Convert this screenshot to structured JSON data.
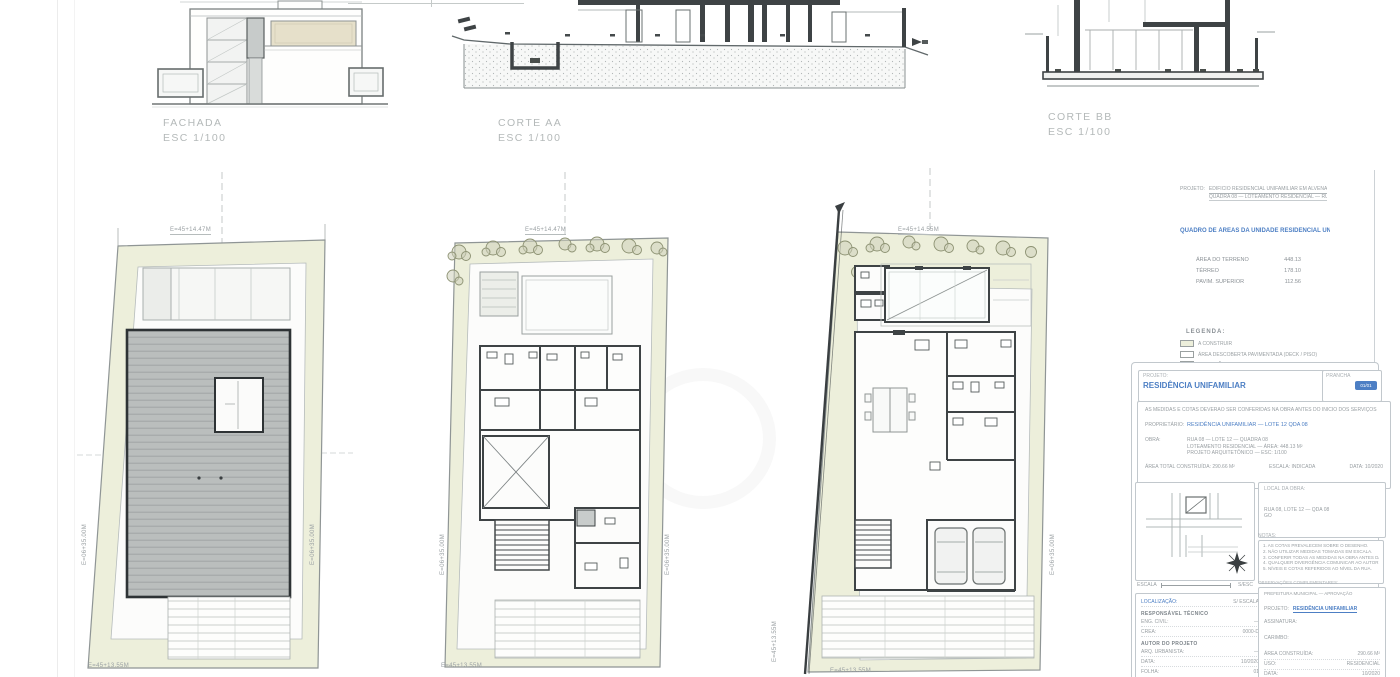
{
  "drawings": {
    "fachada": {
      "title": "FACHADA",
      "scale": "ESC   1/100"
    },
    "corte_aa": {
      "title": "CORTE  AA",
      "scale": "ESC   1/100"
    },
    "corte_bb": {
      "title": "CORTE  BB",
      "scale": "ESC  1/100"
    }
  },
  "plans": {
    "roof": {
      "dim_top": "E=45+14.47M",
      "dim_bottom": "E=45+13.55M",
      "dim_left": "E=06+35.00M",
      "dim_right": "E=06+35.00M"
    },
    "upper": {
      "dim_top": "E=45+14.47M",
      "dim_bottom": "E=45+13.55M",
      "dim_left": "E=06+35.00M",
      "dim_right": "E=06+35.00M"
    },
    "ground": {
      "dim_top": "E=45+14.55M",
      "dim_bottom": "E=45+13.55M",
      "dim_left": "E=45+13.55M",
      "dim_right": "E=06+35.00M"
    }
  },
  "info_panel": {
    "project_label": "PROJETO:",
    "project_line1": "EDIFICIO RESIDENCIAL UNIFAMILIAR EM ALVENARIA — LOTE 12",
    "project_line2": "QUADRA 08 — LOTEAMENTO RESIDENCIAL — RUA 08",
    "areas_title": "QUADRO DE ÁREAS DA UNIDADE RESIDENCIAL UNIFAMILIAR",
    "areas": [
      {
        "label": "ÁREA DO TERRENO",
        "value": "448.13"
      },
      {
        "label": "TÉRREO",
        "value": "178.10"
      },
      {
        "label": "PAVIM. SUPERIOR",
        "value": "112.56"
      }
    ],
    "legend_title": "LEGENDA:",
    "legend": [
      {
        "label": "A CONSTRUIR"
      },
      {
        "label": "ÁREA DESCOBERTA PAVIMENTADA (DECK / PISO)"
      },
      {
        "label": "PROJEÇÃO COBERTURA"
      },
      {
        "label": "LIMITE DO LOTE"
      }
    ]
  },
  "titleblock": {
    "header": {
      "label": "PROJETO:",
      "name": "RESIDÊNCIA UNIFAMILIAR",
      "sheet_label": "PRANCHA",
      "badge": "01/01"
    },
    "main": {
      "note": "AS MEDIDAS E COTAS DEVERÃO SER CONFERIDAS NA OBRA ANTES DO INÍCIO DOS SERVIÇOS",
      "owner_label": "PROPRIETÁRIO:",
      "owner_value": "RESIDÊNCIA UNIFAMILIAR — LOTE 12 QDA 08",
      "site_label": "OBRA:",
      "site_line1": "RUA 08 — LOTE 12 — QUADRA 08",
      "site_line2": "LOTEAMENTO RESIDENCIAL — ÁREA: 448.13 M²",
      "site_line3": "PROJETO ARQUITETÔNICO — ESC: 1/100",
      "footer_left": "ÁREA TOTAL CONSTRUÍDA: 290.66 M²",
      "footer_mid": "ESCALA: INDICADA",
      "footer_right": "DATA: 10/2020"
    },
    "map": {
      "scale_left": "ESCALA",
      "scale_right": "S/ESC"
    },
    "left_fields": [
      {
        "label": "LOCALIZAÇÃO:",
        "value": "S/ ESCALA"
      },
      {
        "label": "RESPONSÁVEL TÉCNICO",
        "value": ""
      },
      {
        "label": "ENG. CIVIL:",
        "value": "—"
      },
      {
        "label": "CREA:",
        "value": "0000-D"
      },
      {
        "label": "AUTOR DO PROJETO",
        "value": ""
      },
      {
        "label": "ARQ. URBANISTA:",
        "value": "—"
      },
      {
        "label": "DATA:",
        "value": "10/2020"
      },
      {
        "label": "FOLHA:",
        "value": "01"
      }
    ],
    "right_top": {
      "label": "LOCAL DA OBRA:",
      "line1": "RUA 08, LOTE 12 — QDA 08",
      "line2": "GO"
    },
    "notes": {
      "label": "NOTAS:",
      "lines": [
        "1. AS COTAS PREVALECEM SOBRE O DESENHO.",
        "2. NÃO UTILIZAR MEDIDAS TOMADAS EM ESCALA.",
        "3. CONFERIR TODAS AS MEDIDAS NA OBRA ANTES DA EXECUÇÃO.",
        "4. QUALQUER DIVERGÊNCIA COMUNICAR AO AUTOR DO PROJETO.",
        "5. NÍVEIS E COTAS REFERIDOS AO NÍVEL DA RUA."
      ]
    },
    "obs_label": "OBSERVAÇÕES COMPLEMENTARES:",
    "right_bottom": {
      "header": "PREFEITURA MUNICIPAL — APROVAÇÃO",
      "proj_label": "PROJETO:",
      "proj_value": "RESIDÊNCIA UNIFAMILIAR",
      "sig_label": "ASSINATURA:",
      "stamp_label": "CARIMBO:",
      "f1_label": "ÁREA CONSTRUÍDA:",
      "f1_value": "290.66 M²",
      "f2_label": "USO:",
      "f2_value": "RESIDENCIAL",
      "f3_label": "DATA:",
      "f3_value": "10/2020"
    }
  }
}
